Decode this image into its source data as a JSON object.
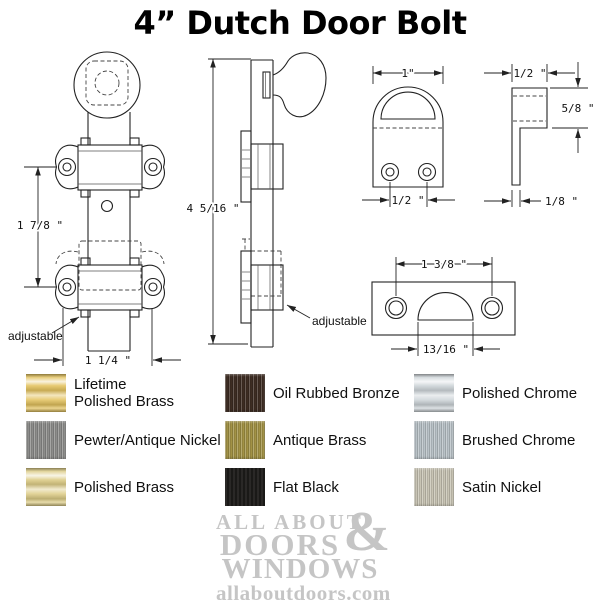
{
  "title": "4” Dutch Door Bolt",
  "colors": {
    "line": "#222222",
    "logo_gray": "#c5c5c5",
    "text": "#000000",
    "background": "#ffffff"
  },
  "drawings": {
    "front_view": {
      "dim_bracket_spacing": "1 7/8 \"",
      "dim_width": "1 1/4 \"",
      "adjustable_label": "adjustable"
    },
    "side_view": {
      "dim_length": "4 5/16 \"",
      "adjustable_label": "adjustable"
    },
    "keeper_front_view": {
      "dim_width": "1\"",
      "dim_hole_spacing": "1/2 \""
    },
    "keeper_side_view": {
      "dim_depth": "1/2 \"",
      "dim_height": "5/8 \"",
      "dim_thickness": "1/8 \""
    },
    "strike_plate_view": {
      "dim_hole_spacing": "1 3/8 \"",
      "dim_opening": "13/16 \""
    }
  },
  "finishes": {
    "columns": [
      {
        "items": [
          {
            "line1": "Lifetime",
            "line2": "Polished Brass",
            "color": "#e3c25e"
          },
          {
            "line1": "Pewter/Antique Nickel",
            "line2": "",
            "color": "#8d8d8b"
          },
          {
            "line1": "Polished Brass",
            "line2": "",
            "color": "#ddcc86"
          }
        ]
      },
      {
        "items": [
          {
            "line1": "Oil Rubbed Bronze",
            "line2": "",
            "color": "#3d2c22"
          },
          {
            "line1": "Antique Brass",
            "line2": "",
            "color": "#a29245"
          },
          {
            "line1": "Flat Black",
            "line2": "",
            "color": "#1f1d1b"
          }
        ]
      },
      {
        "items": [
          {
            "line1": "Polished Chrome",
            "line2": "",
            "color": "#cdd4d8"
          },
          {
            "line1": "Brushed Chrome",
            "line2": "",
            "color": "#b9c2c7"
          },
          {
            "line1": "Satin Nickel",
            "line2": "",
            "color": "#c8c4b4"
          }
        ]
      }
    ]
  },
  "logo": {
    "line1": "ALL ABOUT",
    "line2": "DOORS",
    "ampersand": "&",
    "line3": "WINDOWS",
    "website": "allaboutdoors.com"
  }
}
